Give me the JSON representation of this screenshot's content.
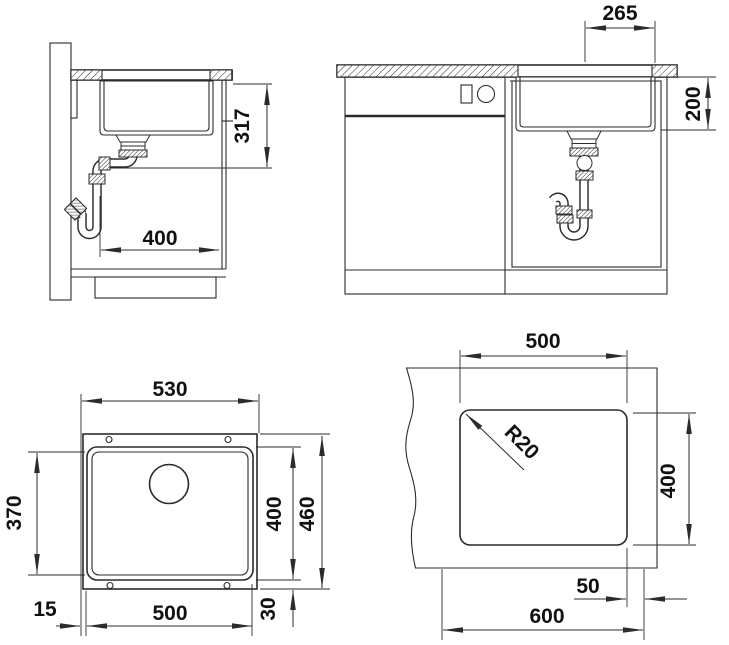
{
  "meta": {
    "type": "technical installation drawing",
    "subject": "undermount kitchen sink, 4 views",
    "background_color": "#ffffff",
    "line_color": "#2b2b2b",
    "text_color": "#111111"
  },
  "views": {
    "side_section": {
      "name": "side section view",
      "dims": {
        "required_depth": "317",
        "clearance_width": "400"
      }
    },
    "front_elevation": {
      "name": "front elevation view",
      "dims": {
        "drain_offset": "265",
        "bowl_depth": "200"
      }
    },
    "plan": {
      "name": "sink plan view",
      "dims": {
        "overall_width": "530",
        "bowl_floor_length": "370",
        "bowl_length": "400",
        "overall_length": "460",
        "rim_offset_side": "15",
        "bowl_width": "500",
        "rim_offset_end": "30"
      }
    },
    "cutout": {
      "name": "worktop cutout view",
      "dims": {
        "cutout_width": "500",
        "corner_radius": "R20",
        "cutout_depth": "400",
        "edge_distance": "50",
        "min_cabinet_width": "600"
      }
    }
  }
}
